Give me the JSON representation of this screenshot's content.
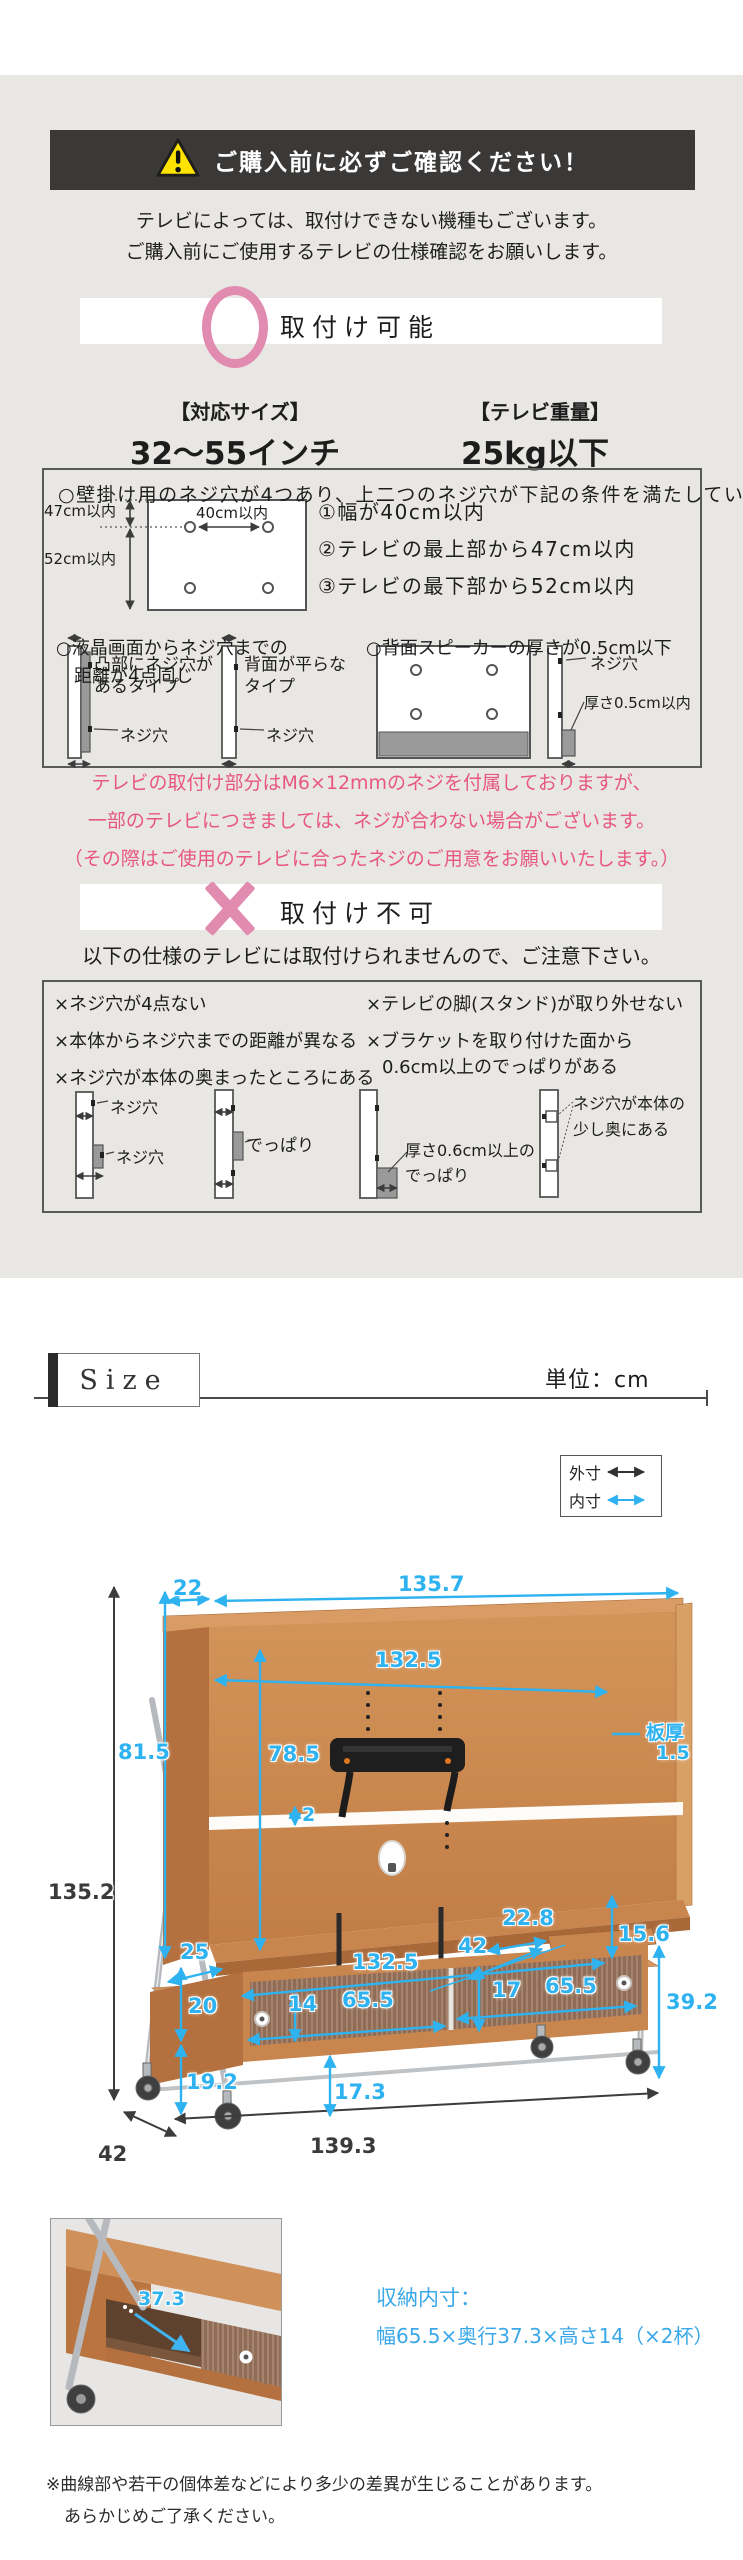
{
  "colors": {
    "section_bg": "#e9e7e3",
    "banner_bg": "#3b3938",
    "accent_pink": "#e18bb0",
    "pink_text": "#e7577f",
    "dim_blue": "#2fb3f0",
    "warning_yellow": "#ffe300",
    "wood": "#c9854e"
  },
  "warning": {
    "title": "ご購入前に必ずご確認ください！",
    "intro": [
      "テレビによっては、取付けできない機種もございます。",
      "ご購入前にご使用するテレビの仕様確認をお願いします。"
    ]
  },
  "mountable": {
    "heading": "取付け可能",
    "spec_size_label": "【対応サイズ】",
    "spec_size_value": "32～55インチ",
    "spec_weight_label": "【テレビ重量】",
    "spec_weight_value": "25kg以下",
    "box": {
      "title": "○壁掛け用のネジ穴が4つあり、上二つのネジ穴が下記の条件を満たしている",
      "label_v_top": "47cm以内",
      "label_width": "40cm以内",
      "label_v_bottom": "52cm以内",
      "conditions": [
        "①幅が40cm以内",
        "②テレビの最上部から47cm以内",
        "③テレビの最下部から52cm以内"
      ],
      "note_distance_1": "○液晶画面からネジ穴までの",
      "note_distance_2": "距離が4点同じ",
      "note_speaker": "○背面スピーカーの厚さが0.5cm以下",
      "type_convex_1": "凸部にネジ穴が",
      "type_convex_2": "あるタイプ",
      "type_flat_1": "背面が平らな",
      "type_flat_2": "タイプ",
      "screw_hole": "ネジ穴",
      "thickness": "厚さ0.5cm以内"
    },
    "screw_note": [
      "テレビの取付け部分はM6×12mmのネジを付属しておりますが、",
      "一部のテレビにつきましては、ネジが合わない場合がございます。",
      "（その際はご使用のテレビに合ったネジのご用意をお願いいたします。）"
    ]
  },
  "not_mountable": {
    "heading": "取付け不可",
    "lead": "以下の仕様のテレビには取付けられませんので、ご注意下さい。",
    "box": {
      "items_left": [
        "×ネジ穴が4点ない",
        "×本体からネジ穴までの距離が異なる",
        "×ネジ穴が本体の奥まったところにある"
      ],
      "items_right_1": "×テレビの脚(スタンド)が取り外せない",
      "items_right_2": "×ブラケットを取り付けた面から",
      "items_right_3": "0.6cm以上のでっぱりがある",
      "screw_hole": "ネジ穴",
      "protrusion": "でっぱり",
      "thick_protrusion_1": "厚さ0.6cm以上の",
      "thick_protrusion_2": "でっぱり",
      "recess_1": "ネジ穴が本体の",
      "recess_2": "少し奥にある"
    }
  },
  "size_section": {
    "title": "Size",
    "unit": "単位：cm",
    "legend_outer": "外寸",
    "legend_inner": "内寸",
    "storage_label": "収納内寸：",
    "storage_value": "幅65.5×奥行37.3×高さ14（×2杯）",
    "notes": [
      "※曲線部や若干の個体差などにより多少の差異が生じることがあります。",
      "あらかじめご了承ください。"
    ]
  },
  "dimensions": {
    "top_depth": "22",
    "top_width": "135.7",
    "inner_width": "132.5",
    "board_label": "板厚",
    "board_thickness": "1.5",
    "upper_height": "81.5",
    "panel_height": "78.5",
    "total_height": "135.2",
    "strip_adjust": "2",
    "shelf_depth": "22.8",
    "lip": "25",
    "gap": "15.6",
    "lower_top_depth": "42",
    "lower_inner_width": "132.5",
    "door_right_h": "17",
    "door_right_w": "65.5",
    "cabinet_right_h": "39.2",
    "cabinet_left_h": "20",
    "door_left_h": "14",
    "door_left_w": "65.5",
    "leg_height": "19.2",
    "floor_clearance": "17.3",
    "depth": "42",
    "total_width": "139.3",
    "photo_depth": "37.3"
  }
}
